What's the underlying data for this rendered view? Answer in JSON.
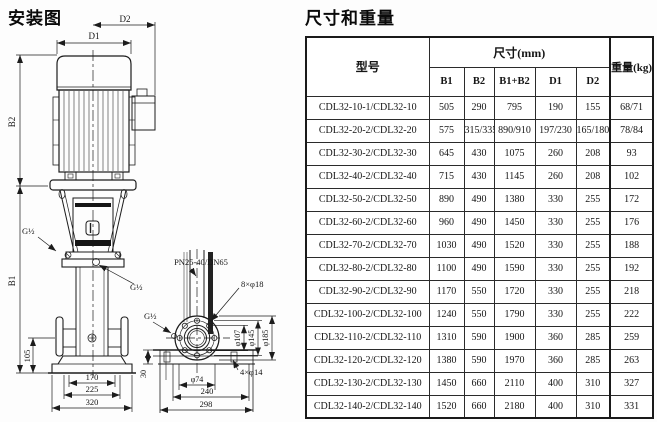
{
  "left_panel": {
    "title": "安装图",
    "labels": {
      "d1": "D1",
      "d2": "D2",
      "b1": "B1",
      "b2": "B2",
      "g_half_1": "G½",
      "g_half_2": "G½",
      "g_half_3": "G½",
      "dim_105": "105",
      "dim_170": "170",
      "dim_225": "225",
      "dim_320": "320",
      "pn_rating": "PN25-40/DN65",
      "flange_bolts": "8×φ18",
      "dia_107": "φ107",
      "dia_145": "φ145",
      "dia_185": "φ185",
      "dia_74": "φ74",
      "dim_240": "240",
      "dim_298": "298",
      "base_bolts": "4×φ14",
      "dim_30": "30"
    }
  },
  "right_panel": {
    "title": "尺寸和重量",
    "table": {
      "header": {
        "model": "型号",
        "size_group": "尺寸(mm)",
        "weight": "重量(kg)",
        "size_cols": [
          "B1",
          "B2",
          "B1+B2",
          "D1",
          "D2"
        ]
      },
      "rows": [
        {
          "model": "CDL32-10-1/CDL32-10",
          "values": [
            "505",
            "290",
            "795",
            "190",
            "155"
          ],
          "weight": "68/71"
        },
        {
          "model": "CDL32-20-2/CDL32-20",
          "values": [
            "575",
            "315/335",
            "890/910",
            "197/230",
            "165/180"
          ],
          "weight": "78/84"
        },
        {
          "model": "CDL32-30-2/CDL32-30",
          "values": [
            "645",
            "430",
            "1075",
            "260",
            "208"
          ],
          "weight": "93"
        },
        {
          "model": "CDL32-40-2/CDL32-40",
          "values": [
            "715",
            "430",
            "1145",
            "260",
            "208"
          ],
          "weight": "102"
        },
        {
          "model": "CDL32-50-2/CDL32-50",
          "values": [
            "890",
            "490",
            "1380",
            "330",
            "255"
          ],
          "weight": "172"
        },
        {
          "model": "CDL32-60-2/CDL32-60",
          "values": [
            "960",
            "490",
            "1450",
            "330",
            "255"
          ],
          "weight": "176"
        },
        {
          "model": "CDL32-70-2/CDL32-70",
          "values": [
            "1030",
            "490",
            "1520",
            "330",
            "255"
          ],
          "weight": "188"
        },
        {
          "model": "CDL32-80-2/CDL32-80",
          "values": [
            "1100",
            "490",
            "1590",
            "330",
            "255"
          ],
          "weight": "192"
        },
        {
          "model": "CDL32-90-2/CDL32-90",
          "values": [
            "1170",
            "550",
            "1720",
            "330",
            "255"
          ],
          "weight": "218"
        },
        {
          "model": "CDL32-100-2/CDL32-100",
          "values": [
            "1240",
            "550",
            "1790",
            "330",
            "255"
          ],
          "weight": "222"
        },
        {
          "model": "CDL32-110-2/CDL32-110",
          "values": [
            "1310",
            "590",
            "1900",
            "360",
            "285"
          ],
          "weight": "259"
        },
        {
          "model": "CDL32-120-2/CDL32-120",
          "values": [
            "1380",
            "590",
            "1970",
            "360",
            "285"
          ],
          "weight": "263"
        },
        {
          "model": "CDL32-130-2/CDL32-130",
          "values": [
            "1450",
            "660",
            "2110",
            "400",
            "310"
          ],
          "weight": "327"
        },
        {
          "model": "CDL32-140-2/CDL32-140",
          "values": [
            "1520",
            "660",
            "2180",
            "400",
            "310"
          ],
          "weight": "331"
        }
      ]
    }
  }
}
